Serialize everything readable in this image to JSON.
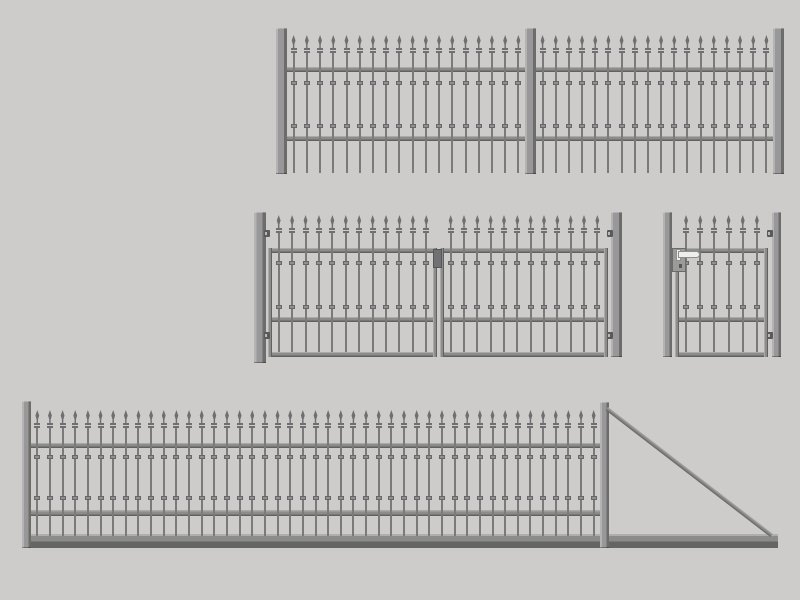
{
  "scene": {
    "title": "wrought-iron fence and gate component set",
    "canvas": {
      "width": 800,
      "height": 600
    },
    "background": "#cdccca",
    "colors": {
      "picket": "#7a7a78",
      "spear": "#6f6f71",
      "knob_fill": "#90908e",
      "knob_edge": "#67676b",
      "rail_light": "#aaaaa8",
      "rail_mid": "#8c8c8a",
      "rail_dark": "#616161",
      "post_light": "#b3b3b1",
      "post_mid": "#98989a",
      "post_dark": "#6c6c6a",
      "track_light": "#aeaeac",
      "track_mid": "#8b8b89",
      "track_dark": "#656563",
      "hinge": "#5a5a5e",
      "latch": "#717173",
      "lock_plate": "#9b9b99",
      "handle": "#eeeeec",
      "handle_edge": "#8e8e8c"
    },
    "assemblies": [
      {
        "name": "fence-run-top",
        "posts": [
          [
            276,
            28,
            11,
            146
          ],
          [
            525,
            28,
            11,
            146
          ],
          [
            773,
            28,
            11,
            146
          ]
        ],
        "rails": [
          [
            287,
            67,
            238,
            5
          ],
          [
            287,
            136,
            238,
            5
          ],
          [
            536,
            67,
            237,
            5
          ],
          [
            536,
            136,
            237,
            5
          ]
        ],
        "sections": [
          {
            "x0": 287,
            "x1": 525,
            "count": 18,
            "tip": 35,
            "barTop": 53,
            "barBottom": 173,
            "knobs": [
              83,
              126
            ]
          },
          {
            "x0": 536,
            "x1": 773,
            "count": 18,
            "tip": 35,
            "barTop": 53,
            "barBottom": 173,
            "knobs": [
              83,
              126
            ]
          }
        ]
      },
      {
        "name": "double-swing-gate",
        "posts": [
          [
            254,
            212,
            12,
            151
          ],
          [
            611,
            212,
            11,
            145
          ]
        ],
        "stiles": [
          [
            268,
            248,
            4,
            109
          ],
          [
            433,
            248,
            4,
            109
          ],
          [
            440,
            248,
            4,
            109
          ],
          [
            604,
            248,
            4,
            109
          ]
        ],
        "rails": [
          [
            268,
            248,
            169,
            5
          ],
          [
            268,
            317,
            169,
            5
          ],
          [
            268,
            352,
            169,
            5
          ],
          [
            440,
            248,
            168,
            5
          ],
          [
            440,
            317,
            168,
            5
          ],
          [
            440,
            352,
            168,
            5
          ]
        ],
        "sections": [
          {
            "x0": 272,
            "x1": 433,
            "count": 12,
            "tip": 215,
            "barTop": 233,
            "barBottom": 352,
            "knobs": [
              263,
              307
            ]
          },
          {
            "x0": 444,
            "x1": 604,
            "count": 12,
            "tip": 215,
            "barTop": 233,
            "barBottom": 352,
            "knobs": [
              263,
              307
            ]
          }
        ],
        "hinges": [
          [
            264,
            230
          ],
          [
            264,
            332
          ],
          [
            607,
            230
          ],
          [
            607,
            332
          ]
        ],
        "latch": [
          433,
          249,
          9,
          19
        ]
      },
      {
        "name": "single-pedestrian-gate",
        "posts": [
          [
            663,
            212,
            9,
            145
          ],
          [
            772,
            212,
            9,
            145
          ]
        ],
        "stiles": [
          [
            675,
            248,
            4,
            109
          ],
          [
            764,
            248,
            4,
            109
          ]
        ],
        "rails": [
          [
            675,
            248,
            93,
            5
          ],
          [
            675,
            317,
            93,
            5
          ],
          [
            675,
            352,
            93,
            5
          ]
        ],
        "sections": [
          {
            "x0": 679,
            "x1": 764,
            "count": 6,
            "tip": 215,
            "barTop": 233,
            "barBottom": 352,
            "knobs": [
              263,
              307
            ]
          }
        ],
        "hinges": [
          [
            767,
            230
          ],
          [
            767,
            332
          ]
        ],
        "lock": {
          "plate": [
            672,
            248,
            14,
            24
          ],
          "rosette": [
            676,
            249,
            5,
            12
          ],
          "lever": [
            678,
            251,
            22,
            7
          ],
          "keyhole": [
            679,
            264,
            3,
            4
          ]
        }
      },
      {
        "name": "cantilever-sliding-gate",
        "track": [
          28,
          534,
          750,
          14
        ],
        "posts": [
          [
            22,
            401,
            9,
            147
          ],
          [
            600,
            402,
            9,
            146
          ]
        ],
        "rails": [
          [
            31,
            443,
            569,
            5
          ],
          [
            31,
            510,
            569,
            6
          ]
        ],
        "sections": [
          {
            "x0": 31,
            "x1": 600,
            "count": 45,
            "tip": 410,
            "barTop": 428,
            "barBottom": 536,
            "knobs": [
              457,
              498
            ]
          }
        ],
        "diagonal": {
          "x1": 608,
          "y1": 407,
          "x2": 773,
          "y2": 534,
          "w": 4
        }
      }
    ]
  }
}
